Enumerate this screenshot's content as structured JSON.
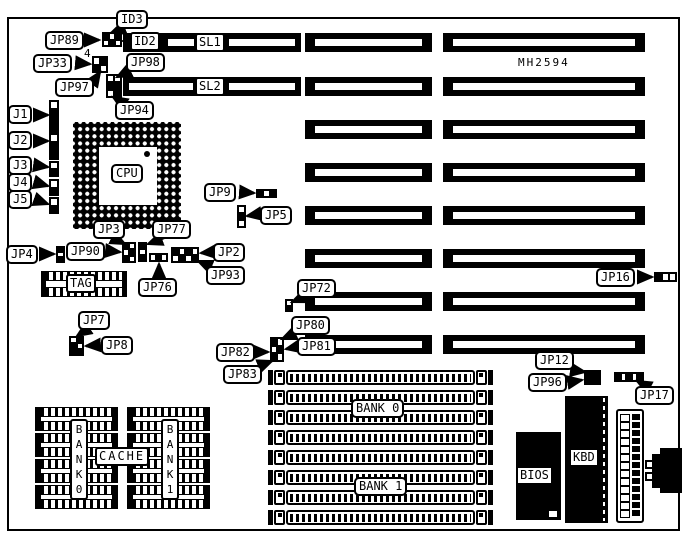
{
  "board": {
    "model": "MH2594",
    "pin_note": "4"
  },
  "labels": {
    "id3": "ID3",
    "jp89": "JP89",
    "id2": "ID2",
    "sl1": "SL1",
    "jp33": "JP33",
    "jp98": "JP98",
    "jp97": "JP97",
    "sl2": "SL2",
    "jp94": "JP94",
    "j1": "J1",
    "j2": "J2",
    "j3": "J3",
    "j4": "J4",
    "j5": "J5",
    "cpu": "CPU",
    "jp9": "JP9",
    "jp5": "JP5",
    "jp3": "JP3",
    "jp77": "JP77",
    "jp4": "JP4",
    "jp90": "JP90",
    "jp2": "JP2",
    "jp93": "JP93",
    "jp76": "JP76",
    "tag": "TAG",
    "jp7": "JP7",
    "jp8": "JP8",
    "jp72": "JP72",
    "jp80": "JP80",
    "jp81": "JP81",
    "jp82": "JP82",
    "jp83": "JP83",
    "jp16": "JP16",
    "jp12": "JP12",
    "jp96": "JP96",
    "jp17": "JP17",
    "bank0_simm": "BANK 0",
    "bank1_simm": "BANK 1",
    "cache": "CACHE",
    "bank0_chips": "B\nA\nN\nK\n0",
    "bank1_chips": "B\nA\nN\nK\n1",
    "bios": "BIOS",
    "kbd": "KBD"
  },
  "colors": {
    "ink": "#000000",
    "paper": "#ffffff"
  }
}
